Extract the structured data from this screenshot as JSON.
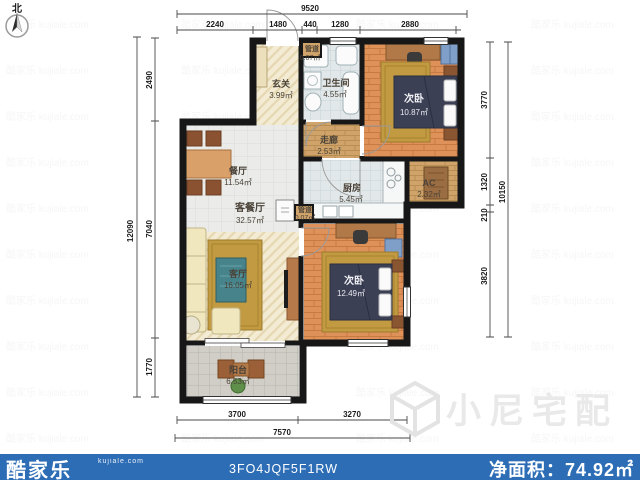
{
  "compass": {
    "label": "北"
  },
  "rooms": {
    "entry": {
      "name": "玄关",
      "area": "3.99㎡"
    },
    "duct_top": {
      "name": "管道",
      "area": "0.07㎡"
    },
    "bathroom": {
      "name": "卫生间",
      "area": "4.55㎡"
    },
    "bedroom_top": {
      "name": "次卧",
      "area": "10.87㎡"
    },
    "corridor": {
      "name": "走廊",
      "area": "2.53㎡"
    },
    "kitchen": {
      "name": "厨房",
      "area": "5.45㎡"
    },
    "ac": {
      "name": "AC",
      "area": "2.32㎡"
    },
    "dining": {
      "name": "餐厅",
      "area": "11.54㎡"
    },
    "living_dining": {
      "name": "客餐厅",
      "area": "32.57㎡"
    },
    "duct_mid": {
      "name": "管道",
      "area": "0.07㎡"
    },
    "bedroom_bottom": {
      "name": "次卧",
      "area": "12.49㎡"
    },
    "living": {
      "name": "客厅",
      "area": "16.05㎡"
    },
    "balcony": {
      "name": "阳台",
      "area": "6.53㎡"
    }
  },
  "dimensions": {
    "top": {
      "total": "9520",
      "segments": [
        "2240",
        "1480",
        "440",
        "1280",
        "2880"
      ]
    },
    "left": {
      "total": "12090",
      "segments": [
        "2490",
        "7040",
        "1770"
      ]
    },
    "right": {
      "total": "10150",
      "segments": [
        "3770",
        "1320",
        "210",
        "3820"
      ]
    },
    "bottom": {
      "total": "7570",
      "segments": [
        "3700",
        "3270"
      ]
    }
  },
  "watermark": {
    "brand": "小尼宅配"
  },
  "footer": {
    "brand": "酷家乐",
    "brand_site": "kujiale.com",
    "plan_code": "3FO4JQF5F1RW",
    "net_area_label": "净面积：",
    "net_area_value": "74.92㎡"
  },
  "colors": {
    "footer_bar": "#2d6db6",
    "walls": "#171717",
    "wood_floor": "#df915a",
    "corridor_floor": "#cfa36a",
    "rug": "#c29a42",
    "bed": "#3b4055",
    "wardrobe": "#7f9fc9",
    "watermark_gray": "#e9e9e9"
  }
}
